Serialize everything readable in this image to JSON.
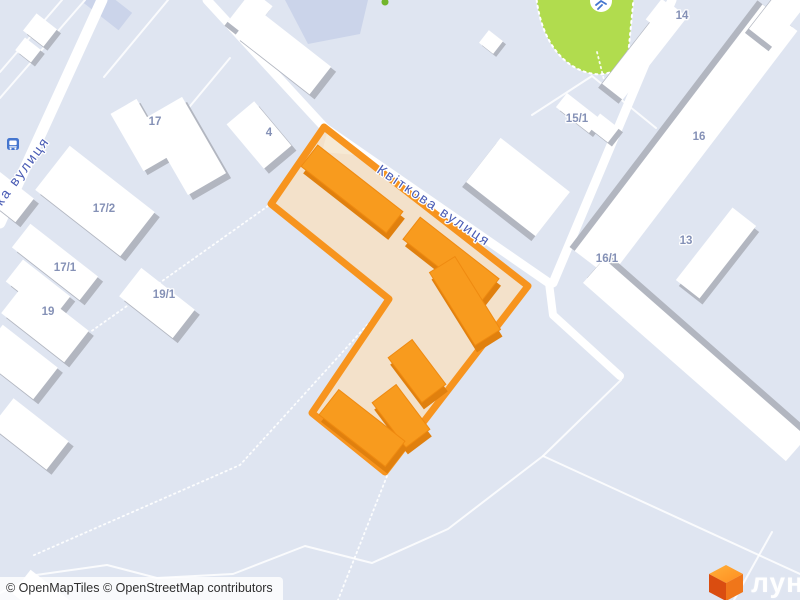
{
  "map": {
    "street_labels": [
      {
        "text": "Квіткова вулиця"
      },
      {
        "text": "ька вулиця"
      }
    ],
    "house_numbers": [
      {
        "text": "17"
      },
      {
        "text": "4"
      },
      {
        "text": "17/2"
      },
      {
        "text": "17/1"
      },
      {
        "text": "19"
      },
      {
        "text": "19/1"
      },
      {
        "text": "15/1"
      },
      {
        "text": "14"
      },
      {
        "text": "16"
      },
      {
        "text": "13"
      },
      {
        "text": "16/1"
      }
    ],
    "icons": {
      "bus_stop": "bus-stop-icon",
      "sports_field": "sports-field-icon",
      "tree": "tree-icon",
      "logo_cube": "lun-cube-icon"
    },
    "colors": {
      "background": "#dfe5f1",
      "road": "#ffffff",
      "building_shadow": "#b2b6c0",
      "green_field": "#b1dc4e",
      "highlight_border": "#f7941e",
      "highlight_fill": "#f3e1ca",
      "highlight_building": "#f89b1e",
      "highlight_building_shadow": "#e0800e",
      "street_label": "#4a5cb5",
      "house_number": "#7f8cb3"
    }
  },
  "attribution": {
    "text": "© OpenMapTiles © OpenStreetMap contributors"
  },
  "logo": {
    "wordmark": "лун"
  }
}
